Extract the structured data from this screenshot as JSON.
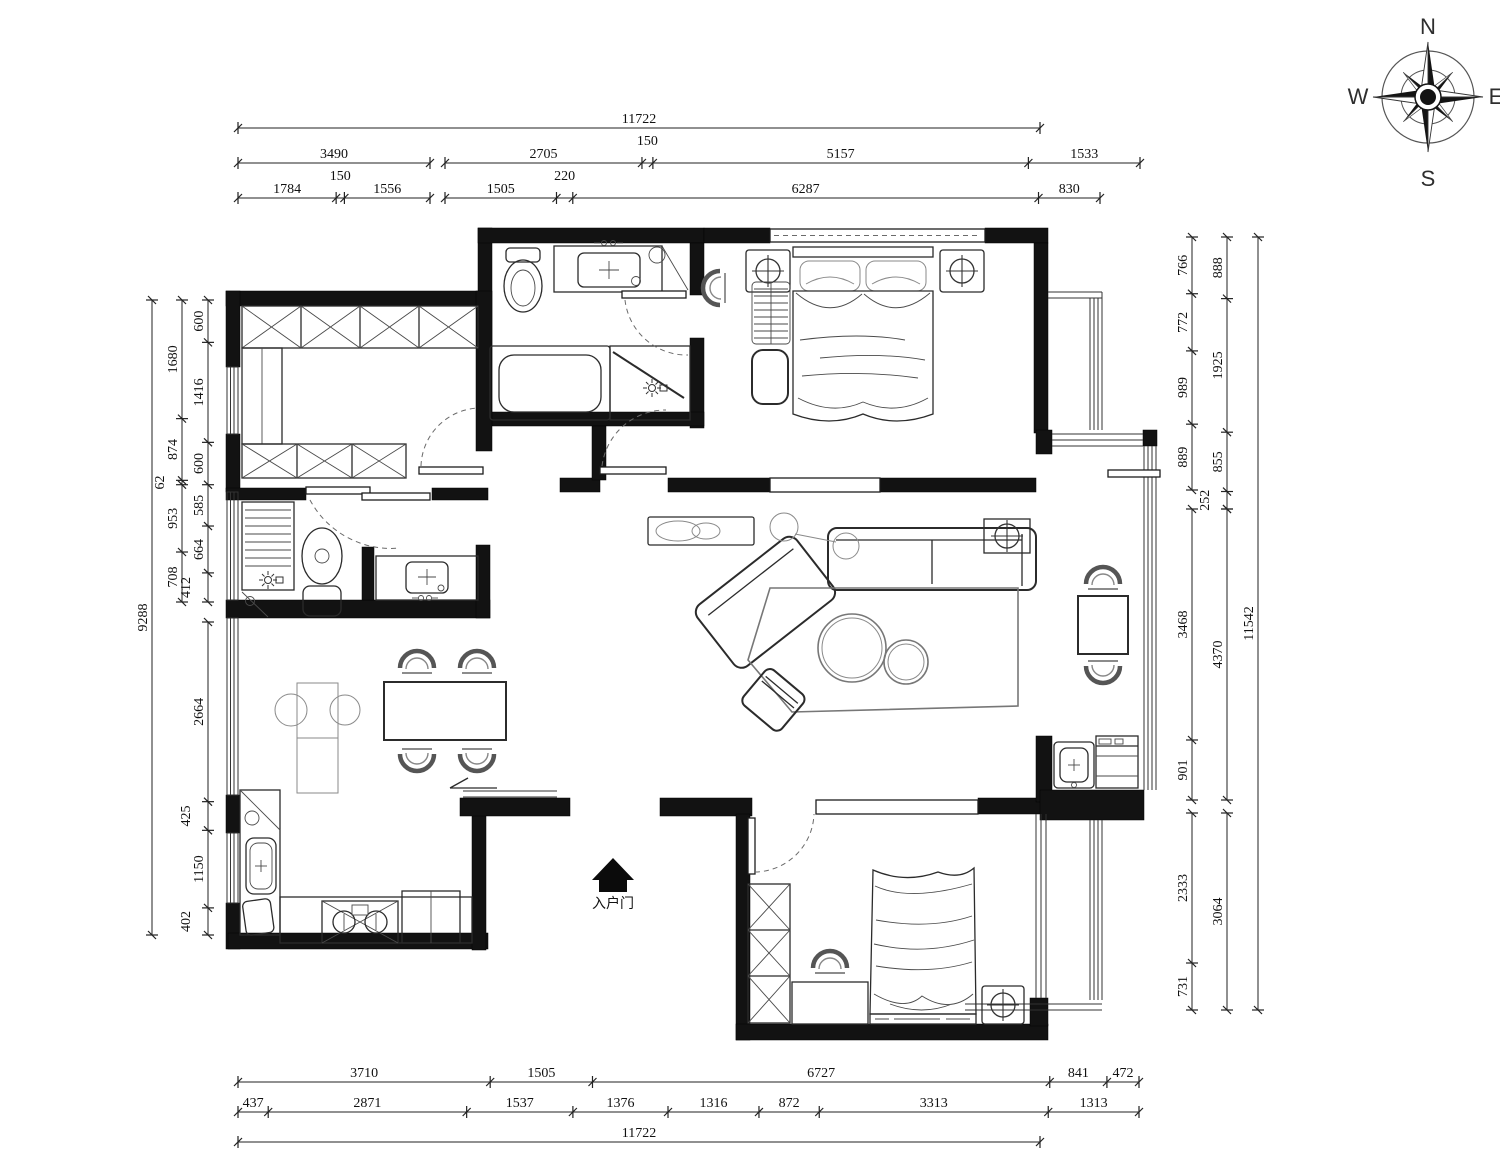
{
  "labels": {
    "entry_door": "入户门"
  },
  "compass": {
    "north": "N",
    "south": "S",
    "east": "E",
    "west": "W"
  },
  "dimensions": {
    "unit": "mm",
    "chains": [
      {
        "name": "top-overall",
        "axis": "h",
        "pos": 128,
        "from": 238,
        "to": 1040,
        "segments": [
          11722
        ]
      },
      {
        "name": "top-row2-left",
        "axis": "h",
        "pos": 163,
        "from": 238,
        "to": 430,
        "segments": [
          3490
        ]
      },
      {
        "name": "top-row2-right",
        "axis": "h",
        "pos": 163,
        "from": 445,
        "to": 1140,
        "segments": [
          2705,
          150,
          5157,
          1533
        ]
      },
      {
        "name": "top-row3-left",
        "axis": "h",
        "pos": 198,
        "from": 238,
        "to": 430,
        "segments": [
          1784,
          150,
          1556
        ]
      },
      {
        "name": "top-row3-right",
        "axis": "h",
        "pos": 198,
        "from": 445,
        "to": 1100,
        "segments": [
          1505,
          220,
          6287,
          830
        ]
      },
      {
        "name": "bottom-row1",
        "axis": "h",
        "pos": 1082,
        "from": 238,
        "to": 1139,
        "segments": [
          3710,
          1505,
          6727,
          841,
          472
        ]
      },
      {
        "name": "bottom-row2",
        "axis": "h",
        "pos": 1112,
        "from": 238,
        "to": 1139,
        "segments": [
          437,
          2871,
          1537,
          1376,
          1316,
          872,
          3313,
          1313
        ]
      },
      {
        "name": "bottom-overall",
        "axis": "h",
        "pos": 1142,
        "from": 238,
        "to": 1040,
        "segments": [
          11722
        ]
      },
      {
        "name": "left-overall",
        "axis": "v",
        "pos": 152,
        "from": 300,
        "to": 935,
        "segments": [
          9288
        ]
      },
      {
        "name": "left-mid",
        "axis": "v",
        "pos": 182,
        "from": 300,
        "to": 602,
        "segments": [
          1680,
          874,
          62,
          953,
          708
        ]
      },
      {
        "name": "left-inner-top",
        "axis": "v",
        "pos": 208,
        "from": 300,
        "to": 602,
        "segments": [
          600,
          1416,
          600,
          585,
          664,
          412
        ]
      },
      {
        "name": "left-inner-bottom",
        "axis": "v",
        "pos": 208,
        "from": 622,
        "to": 935,
        "segments": [
          2664,
          425,
          1150,
          402
        ]
      },
      {
        "name": "right-inner-top",
        "axis": "v",
        "pos": 1192,
        "from": 237,
        "to": 490,
        "segments": [
          766,
          772,
          989,
          889
        ]
      },
      {
        "name": "right-inner-mid",
        "axis": "v",
        "pos": 1192,
        "from": 509,
        "to": 800,
        "segments": [
          3468,
          901
        ]
      },
      {
        "name": "right-inner-bottom",
        "axis": "v",
        "pos": 1192,
        "from": 813,
        "to": 1010,
        "segments": [
          2333,
          731
        ]
      },
      {
        "name": "right-mid-top",
        "axis": "v",
        "pos": 1227,
        "from": 237,
        "to": 509,
        "segments": [
          888,
          1925,
          855,
          252
        ]
      },
      {
        "name": "right-mid-mid",
        "axis": "v",
        "pos": 1227,
        "from": 509,
        "to": 800,
        "segments": [
          4370
        ]
      },
      {
        "name": "right-mid-bottom",
        "axis": "v",
        "pos": 1227,
        "from": 813,
        "to": 1010,
        "segments": [
          3064
        ]
      },
      {
        "name": "right-overall",
        "axis": "v",
        "pos": 1258,
        "from": 237,
        "to": 1010,
        "segments": [
          11542
        ]
      }
    ]
  }
}
